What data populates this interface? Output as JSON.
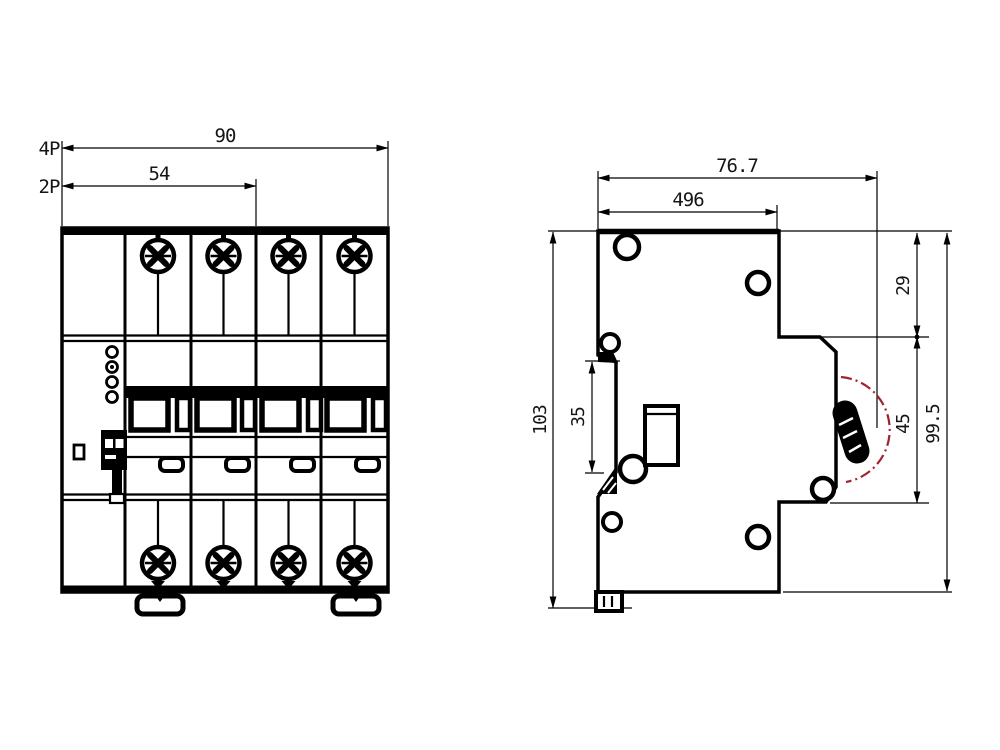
{
  "front_view": {
    "label_4p": "4P",
    "label_2p": "2P",
    "dim_overall_width": "90",
    "dim_two_pole_width": "54"
  },
  "side_view": {
    "dim_total_depth": "76.7",
    "dim_body_depth": "496",
    "dim_top_step": "29",
    "dim_front_face_height": "45",
    "dim_body_height": "99.5",
    "dim_total_height": "103",
    "dim_din_rail_width": "35"
  },
  "colors": {
    "line": "#000000",
    "swing_arc_red": "#9e2430",
    "background": "#ffffff"
  }
}
